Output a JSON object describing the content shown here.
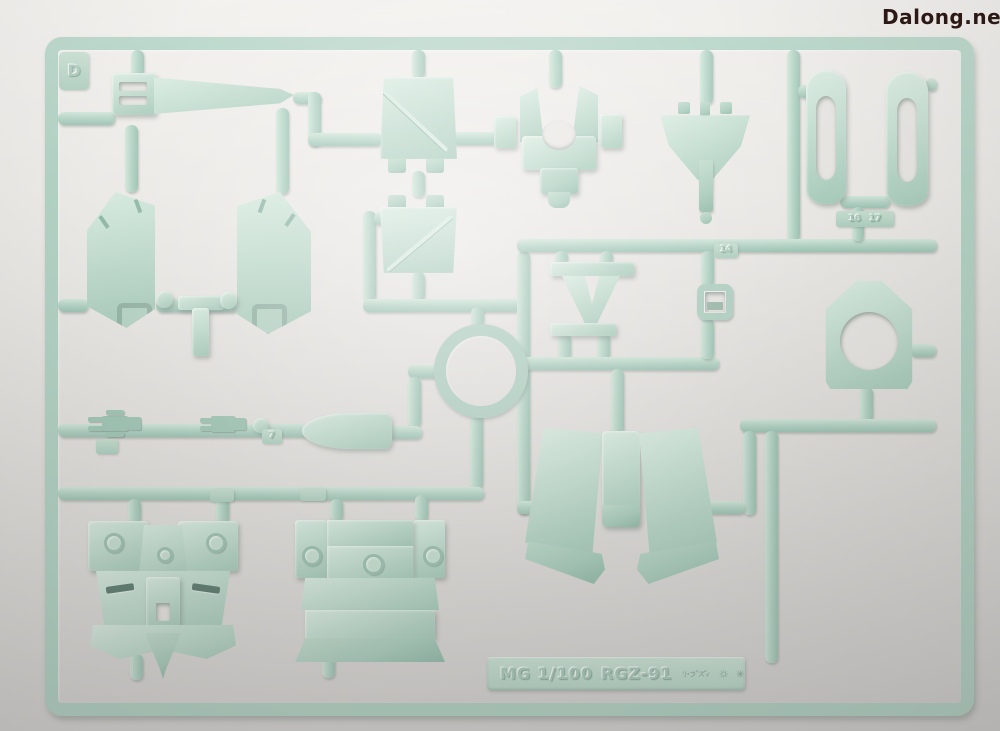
{
  "photo": {
    "background_hex": "#eae8e5",
    "subject": "plastic model kit runner (sprue) on white backdrop"
  },
  "watermark": {
    "text": "Dalong.net",
    "color_hex": "#2c1915"
  },
  "sprue": {
    "plastic_hex": "#b3d3c5",
    "plastic_highlight_hex": "#d9ece1",
    "plastic_shadow_hex": "#8fb5a5",
    "runner_letter": "D",
    "molded_label": {
      "scale_text": "MG 1/100",
      "model_code": "RGZ-91",
      "kana_text": "リ・ガズィ"
    },
    "mold_marks": [
      "gear-mold-mark",
      "asterisk-mold-mark"
    ],
    "part_numbers": {
      "tab_14": "14",
      "tab_16": "16",
      "tab_17": "17",
      "tab_7": "7"
    }
  }
}
